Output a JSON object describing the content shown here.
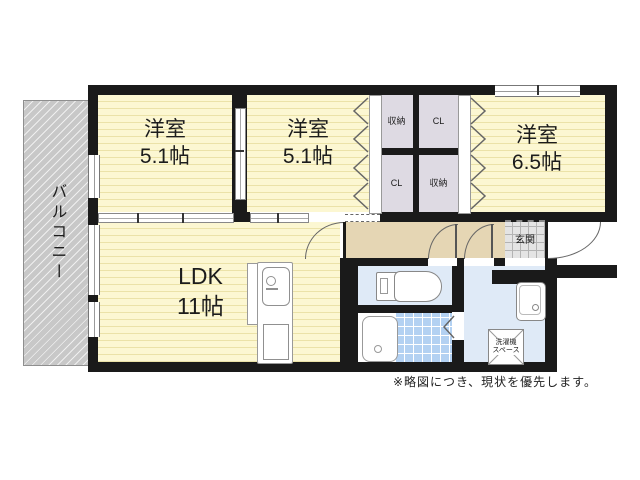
{
  "floorplan": {
    "balcony_label": "バルコニー",
    "rooms": [
      {
        "id": "bedroom-1",
        "name": "洋室",
        "size": "5.1帖"
      },
      {
        "id": "bedroom-2",
        "name": "洋室",
        "size": "5.1帖"
      },
      {
        "id": "bedroom-3",
        "name": "洋室",
        "size": "6.5帖"
      },
      {
        "id": "ldk",
        "name": "LDK",
        "size": "11帖"
      }
    ],
    "storage": {
      "top_left": "収納",
      "top_right": "CL",
      "bottom_left": "CL",
      "bottom_right": "収納"
    },
    "entrance_label": "玄関",
    "laundry": {
      "line1": "洗濯機",
      "line2": "スペース"
    },
    "note": "※略図につき、現状を優先します。",
    "colors": {
      "room_fill": "#fcf7d2",
      "room_stripe": "#ebe2a8",
      "hall_fill": "#e5d6b4",
      "wet_fill": "#dfeaf7",
      "bath_tile": "#b3d1f2",
      "closet_fill": "#dedae3",
      "balcony_fill": "#c8c8c8",
      "wall": "#1a1a1a"
    }
  }
}
